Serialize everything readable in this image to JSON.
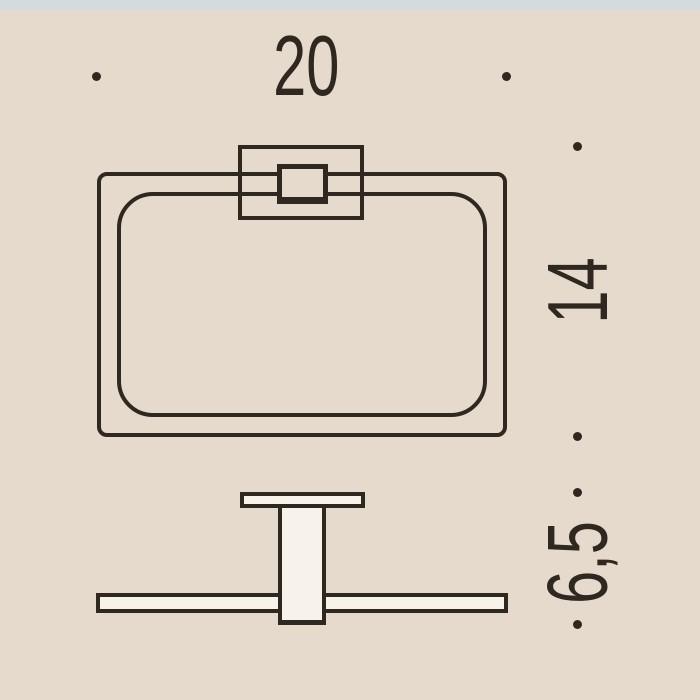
{
  "page": {
    "background_color": "#e5dacb",
    "top_strip_color": "#d5dadd",
    "line_color": "#2f2820",
    "shape_fill_color": "#f7f2ea"
  },
  "dimensions": {
    "width": "20",
    "height": "14",
    "depth": "6,5"
  }
}
